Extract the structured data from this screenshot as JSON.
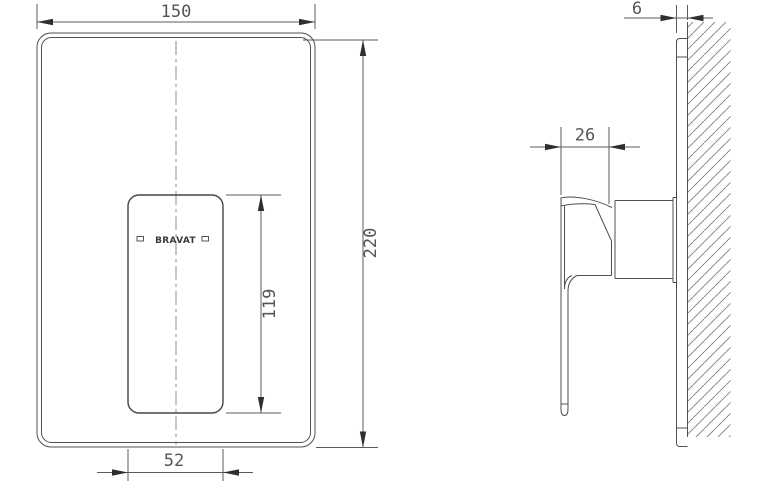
{
  "drawing": {
    "brand_logo": "BRAVAT",
    "front_view": {
      "plate_width": "150",
      "plate_height": "220",
      "handle_plate_height": "119",
      "handle_plate_width": "52"
    },
    "side_view": {
      "handle_depth": "26",
      "wall_plate_thickness": "6"
    },
    "colors": {
      "background": "#ffffff",
      "part_line": "#4f4f4f",
      "dimension_line": "#5c5c5c",
      "arrow": "#2f2f2f",
      "hatch": "#7d7d7d"
    }
  }
}
